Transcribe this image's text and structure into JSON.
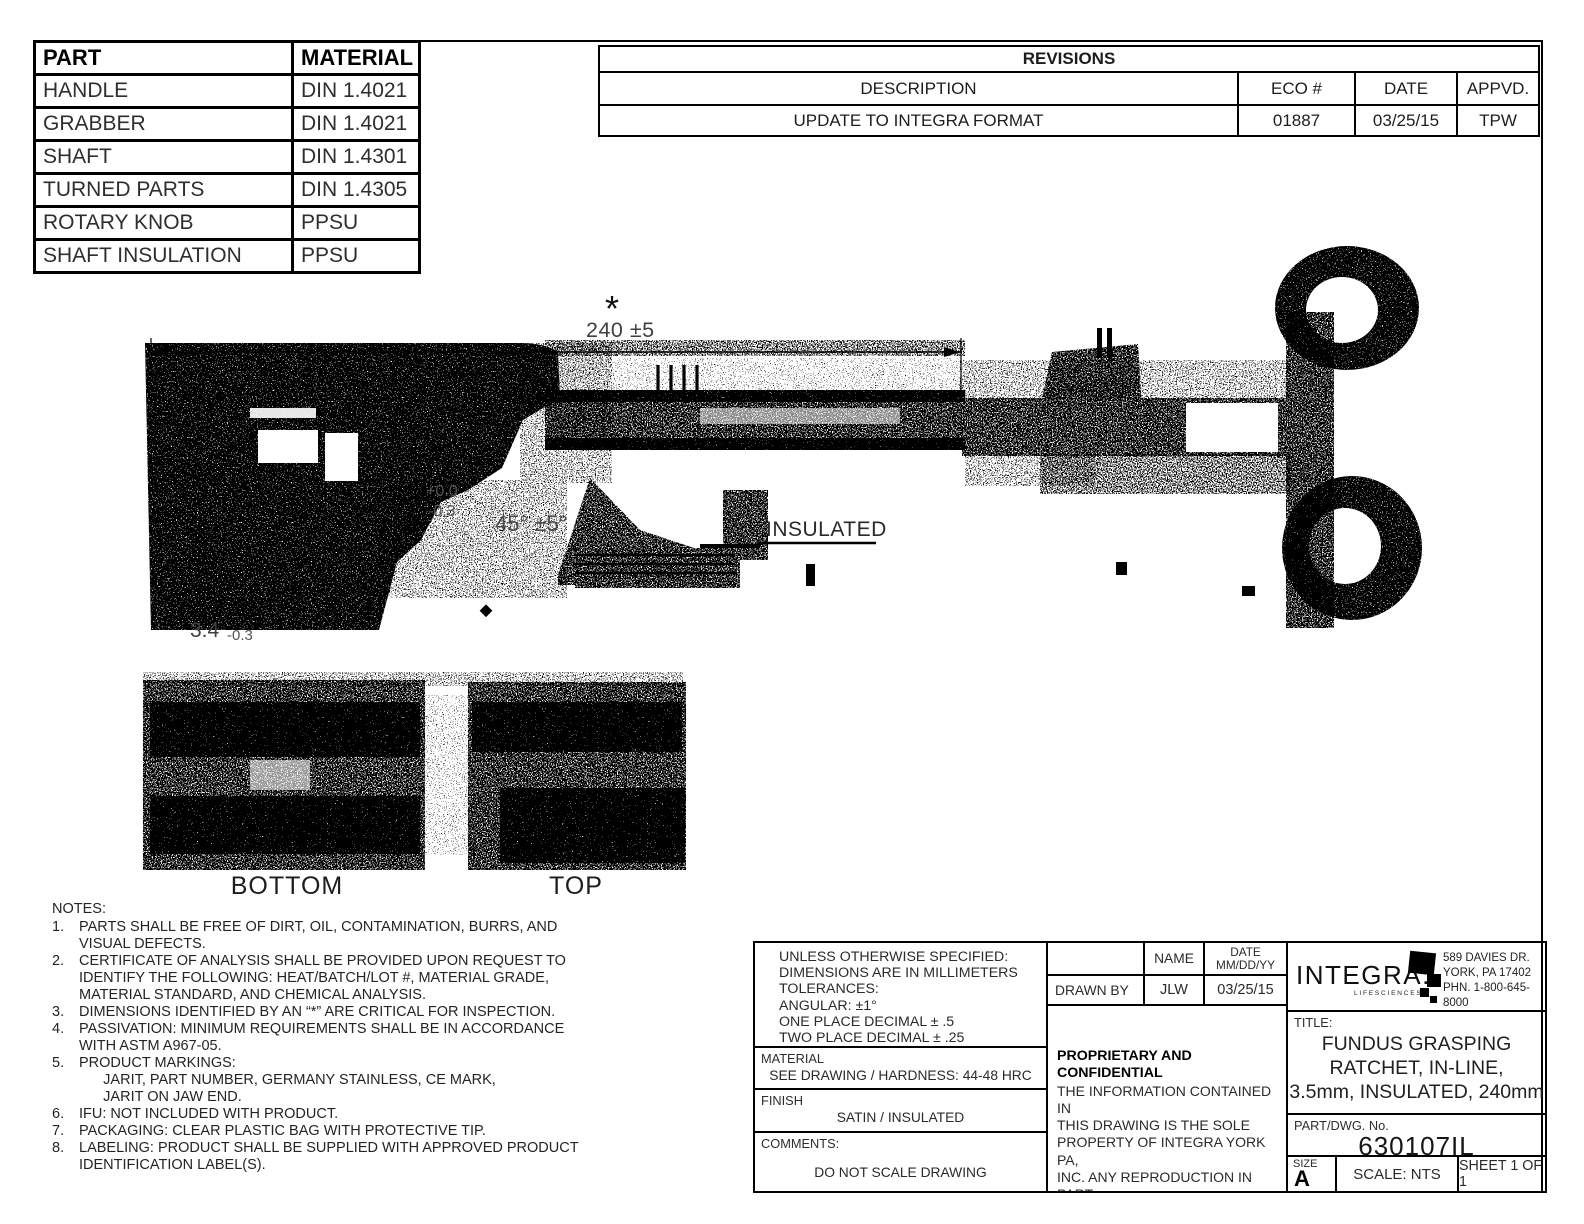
{
  "part_material_table": {
    "headers": [
      "PART",
      "MATERIAL"
    ],
    "rows": [
      [
        "HANDLE",
        "DIN 1.4021"
      ],
      [
        "GRABBER",
        "DIN 1.4021"
      ],
      [
        "SHAFT",
        "DIN 1.4301"
      ],
      [
        "TURNED PARTS",
        "DIN 1.4305"
      ],
      [
        "ROTARY KNOB",
        "PPSU"
      ],
      [
        "SHAFT INSULATION",
        "PPSU"
      ]
    ]
  },
  "revisions": {
    "title": "REVISIONS",
    "headers": [
      "DESCRIPTION",
      "ECO #",
      "DATE",
      "APPVD."
    ],
    "rows": [
      [
        "UPDATE TO INTEGRA FORMAT",
        "01887",
        "03/25/15",
        "TPW"
      ]
    ]
  },
  "drawing": {
    "critical_marker": "*",
    "overall_length_dim": "240 ±5",
    "jaw_tol_plus": "+0.0",
    "jaw_tol_minus": "-0.3",
    "jaw_angle_dim": "45° ±5°",
    "tip_width_dim": "3.4",
    "tip_width_tol": "-0.3",
    "insulated_label": "INSULATED",
    "view_bottom_label": "BOTTOM",
    "view_top_label": "TOP"
  },
  "notes": {
    "title": "NOTES:",
    "items": [
      {
        "n": "1.",
        "t": "PARTS SHALL BE FREE OF DIRT, OIL, CONTAMINATION, BURRS, AND\nVISUAL DEFECTS."
      },
      {
        "n": "2.",
        "t": "CERTIFICATE OF ANALYSIS SHALL BE PROVIDED UPON REQUEST TO\nIDENTIFY THE FOLLOWING: HEAT/BATCH/LOT #, MATERIAL GRADE,\nMATERIAL STANDARD, AND CHEMICAL ANALYSIS."
      },
      {
        "n": "3.",
        "t": "DIMENSIONS IDENTIFIED BY AN “*” ARE CRITICAL FOR INSPECTION."
      },
      {
        "n": "4.",
        "t": "PASSIVATION: MINIMUM REQUIREMENTS SHALL BE IN ACCORDANCE\nWITH ASTM A967-05."
      },
      {
        "n": "5.",
        "t": "PRODUCT MARKINGS:\n      JARIT, PART NUMBER, GERMANY STAINLESS, CE MARK,\n      JARIT ON JAW END."
      },
      {
        "n": "6.",
        "t": "IFU: NOT INCLUDED WITH PRODUCT."
      },
      {
        "n": "7.",
        "t": "PACKAGING: CLEAR PLASTIC BAG WITH PROTECTIVE TIP."
      },
      {
        "n": "8.",
        "t": "LABELING: PRODUCT SHALL BE SUPPLIED WITH APPROVED PRODUCT\nIDENTIFICATION LABEL(S)."
      }
    ]
  },
  "title_block": {
    "tolerance_note": "UNLESS OTHERWISE SPECIFIED:\nDIMENSIONS ARE IN MILLIMETERS\nTOLERANCES:\nANGULAR: ±1°\nONE PLACE DECIMAL ± .5\nTWO PLACE DECIMAL ± .25",
    "material_label": "MATERIAL",
    "material_value": "SEE DRAWING / HARDNESS: 44-48 HRC",
    "finish_label": "FINISH",
    "finish_value": "SATIN / INSULATED",
    "comments_label": "COMMENTS:",
    "comments_value": "DO NOT SCALE DRAWING",
    "name_col_header": "NAME",
    "date_col_header": "DATE\nMM/DD/YY",
    "drawn_by_label": "DRAWN BY",
    "drawn_by_name": "JLW",
    "drawn_by_date": "03/25/15",
    "proprietary_title": "PROPRIETARY AND CONFIDENTIAL",
    "proprietary_text": "THE INFORMATION CONTAINED IN\nTHIS DRAWING IS THE SOLE\nPROPERTY OF INTEGRA YORK PA,\nINC.  ANY REPRODUCTION IN PART\nOR AS A WHOLE WITHOUT THE\nWRITTEN PERMISSION OF INTEGRA\nYORK PA, INC. IS PROHIBITED.",
    "logo_word": "INTEGRA.",
    "logo_tagline": "LIFESCIENCES",
    "address": "589 DAVIES DR.\nYORK, PA 17402\nPHN. 1-800-645-8000",
    "title_label": "TITLE:",
    "title_value": "FUNDUS GRASPING\nRATCHET, IN-LINE,\n3.5mm, INSULATED, 240mm",
    "part_no_label": "PART/DWG. No.",
    "part_no_value": "630107IL",
    "size_label": "SIZE",
    "size_value": "A",
    "scale_value": "SCALE: NTS",
    "sheet_value": "SHEET 1 OF 1"
  }
}
